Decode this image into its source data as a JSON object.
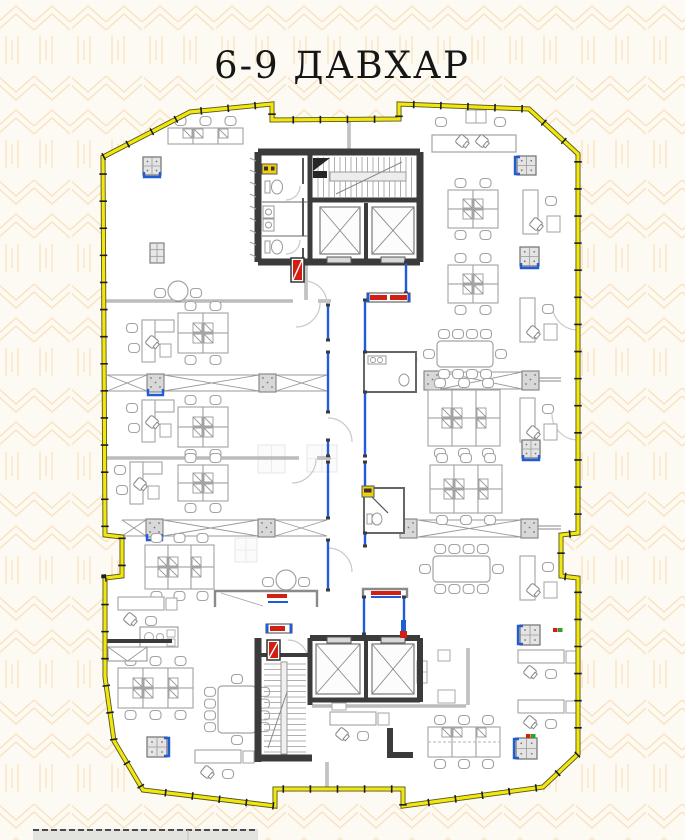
{
  "title": "6-9 ДАВХАР",
  "colors": {
    "bg": "#fdfaf3",
    "pattern": "#f8e2bb",
    "floor": "#ffffff",
    "outer_yellow": "#f2e70d",
    "outer_edge": "#55551f",
    "tick": "#1c1c1c",
    "wall": "#3b3b3b",
    "thin": "#787878",
    "fur": "#a3a3a3",
    "fur_light": "#e4e4e4",
    "glass": "#1f5cd6",
    "red": "#d21f14",
    "badge": "#f2cf0a",
    "green": "#2fa12f",
    "ghost": "#cccccc",
    "strip_fill": "#e3e3e0",
    "strip_border": "#4a4a4a"
  },
  "outline": [
    [
      103,
      157
    ],
    [
      190,
      112
    ],
    [
      272,
      104
    ],
    [
      272,
      120
    ],
    [
      399,
      119
    ],
    [
      399,
      104
    ],
    [
      529,
      109
    ],
    [
      578,
      154
    ],
    [
      578,
      533
    ],
    [
      561,
      535
    ],
    [
      561,
      576
    ],
    [
      578,
      578
    ],
    [
      578,
      754
    ],
    [
      543,
      787
    ],
    [
      403,
      806
    ],
    [
      403,
      789
    ],
    [
      275,
      789
    ],
    [
      275,
      806
    ],
    [
      143,
      790
    ],
    [
      114,
      741
    ],
    [
      105,
      677
    ],
    [
      105,
      578
    ],
    [
      122,
      576
    ],
    [
      122,
      537
    ],
    [
      105,
      535
    ]
  ],
  "thin_walls": [
    [
      105,
      301,
      293,
      301
    ],
    [
      318,
      301,
      331,
      301
    ],
    [
      105,
      458,
      299,
      458
    ],
    [
      317,
      458,
      331,
      458
    ],
    [
      312,
      706,
      466,
      706
    ],
    [
      468,
      648,
      468,
      705
    ],
    [
      327,
      762,
      327,
      789
    ],
    [
      349,
      122,
      349,
      152
    ],
    [
      306,
      262,
      306,
      300
    ]
  ],
  "dark_walls": [
    [
      258,
      152,
      420,
      152,
      7
    ],
    [
      258,
      152,
      258,
      262,
      7
    ],
    [
      420,
      152,
      420,
      262,
      7
    ],
    [
      258,
      262,
      420,
      262,
      7
    ],
    [
      310,
      155,
      310,
      259,
      5
    ],
    [
      310,
      200,
      420,
      200,
      5
    ],
    [
      366,
      203,
      366,
      259,
      4
    ],
    [
      258,
      638,
      258,
      762,
      7
    ],
    [
      310,
      638,
      310,
      705,
      5
    ],
    [
      310,
      638,
      420,
      638,
      6
    ],
    [
      420,
      638,
      420,
      702,
      6
    ],
    [
      366,
      640,
      366,
      700,
      4
    ],
    [
      312,
      700,
      420,
      700,
      5
    ],
    [
      258,
      655,
      310,
      655,
      4
    ],
    [
      258,
      758,
      312,
      758,
      7
    ],
    [
      390,
      728,
      390,
      758,
      6
    ],
    [
      388,
      755,
      413,
      755,
      6
    ],
    [
      105,
      641,
      172,
      641,
      4
    ]
  ],
  "glass": [
    [
      328,
      305,
      328,
      340
    ],
    [
      328,
      352,
      328,
      412
    ],
    [
      328,
      440,
      328,
      456
    ],
    [
      328,
      462,
      328,
      518
    ],
    [
      328,
      540,
      328,
      590
    ],
    [
      365,
      300,
      365,
      352
    ],
    [
      365,
      392,
      365,
      456
    ],
    [
      365,
      462,
      365,
      488
    ],
    [
      365,
      533,
      365,
      546
    ],
    [
      364,
      597,
      364,
      634
    ],
    [
      404,
      597,
      404,
      630
    ],
    [
      406,
      262,
      406,
      293
    ],
    [
      578,
      328,
      578,
      345
    ],
    [
      578,
      412,
      578,
      438
    ]
  ],
  "arcs": [
    "M320,303 A24 24 0 0 1 296,327",
    "M316,459 A24 24 0 0 1 292,483",
    "M328,418 A24 24 0 0 1 352,442",
    "M328,548 A24 24 0 0 1 352,572",
    "M304,281 A23 23 0 0 1 327,304",
    "M417,358 A18 18 0 0 1 399,376",
    "M398,532 A18 18 0 0 0 380,514",
    "M288,640 A20 20 0 0 1 308,660",
    "M300,186 A14 14 0 0 1 286,200",
    "M300,240 A14 14 0 0 1 286,254",
    "M578,330 A26 26 0 0 1 552,304",
    "M578,440 A26 26 0 0 1 552,414"
  ],
  "strips": [
    {
      "y": 375,
      "h": 16,
      "posts": [
        147,
        259
      ],
      "spans": [
        [
          107,
          147
        ],
        [
          164,
          259
        ],
        [
          276,
          327
        ]
      ],
      "tail": null,
      "blue": [
        147
      ]
    },
    {
      "y": 520,
      "h": 16,
      "posts": [
        146,
        258
      ],
      "spans": [
        [
          122,
          146
        ],
        [
          163,
          258
        ],
        [
          275,
          327
        ]
      ],
      "tail": null,
      "blue": [
        146
      ]
    },
    {
      "y": 372,
      "h": 17,
      "posts": [
        424,
        522
      ],
      "spans": [
        [
          441,
          522
        ]
      ],
      "tail": [
        539,
        561
      ],
      "blue": []
    },
    {
      "y": 520,
      "h": 17,
      "posts": [
        400,
        521
      ],
      "spans": [
        [
          418,
          521
        ]
      ],
      "tail": [
        538,
        561
      ],
      "blue": []
    }
  ],
  "pods": [
    {
      "x": 178,
      "y": 313,
      "cols": 2,
      "rows": 2,
      "cw": 25,
      "ch": 20
    },
    {
      "x": 178,
      "y": 407,
      "cols": 2,
      "rows": 2,
      "cw": 25,
      "ch": 20
    },
    {
      "x": 178,
      "y": 465,
      "cols": 2,
      "rows": 2,
      "cw": 25,
      "ch": 18
    },
    {
      "x": 145,
      "y": 545,
      "cols": 3,
      "rows": 2,
      "cw": 23,
      "ch": 22
    },
    {
      "x": 448,
      "y": 190,
      "cols": 2,
      "rows": 2,
      "cw": 25,
      "ch": 19
    },
    {
      "x": 448,
      "y": 265,
      "cols": 2,
      "rows": 2,
      "cw": 25,
      "ch": 19
    },
    {
      "x": 428,
      "y": 390,
      "cols": 3,
      "rows": 2,
      "cw": 24,
      "ch": 28
    },
    {
      "x": 430,
      "y": 465,
      "cols": 3,
      "rows": 2,
      "cw": 24,
      "ch": 24
    },
    {
      "x": 118,
      "y": 668,
      "cols": 3,
      "rows": 2,
      "cw": 25,
      "ch": 20
    },
    {
      "x": 168,
      "y": 128,
      "cols": 3,
      "rows": 1,
      "cw": 25,
      "ch": 16,
      "chairs": "top"
    },
    {
      "x": 428,
      "y": 727,
      "cols": 3,
      "rows": 1,
      "cw": 24,
      "ch": 30,
      "dash": true
    }
  ],
  "confs": [
    {
      "x": 437,
      "y": 341,
      "w": 56,
      "h": 26,
      "dir": "h",
      "n": 4
    },
    {
      "x": 433,
      "y": 556,
      "w": 57,
      "h": 26,
      "dir": "h",
      "n": 4
    },
    {
      "x": 218,
      "y": 686,
      "w": 38,
      "h": 47,
      "dir": "v",
      "n": 4
    }
  ],
  "rounds": [
    {
      "cx": 178,
      "cy": 291,
      "r": 10
    },
    {
      "cx": 286,
      "cy": 580,
      "r": 10
    }
  ],
  "ldesks": [
    {
      "x": 130,
      "y": 320,
      "t": "L"
    },
    {
      "x": 130,
      "y": 400,
      "t": "L"
    },
    {
      "x": 118,
      "y": 462,
      "t": "L"
    },
    {
      "x": 523,
      "y": 190,
      "t": "R"
    },
    {
      "x": 520,
      "y": 298,
      "t": "R"
    },
    {
      "x": 520,
      "y": 398,
      "t": "R"
    },
    {
      "x": 520,
      "y": 556,
      "t": "R"
    },
    {
      "x": 518,
      "y": 650,
      "t": "H"
    },
    {
      "x": 518,
      "y": 700,
      "t": "H"
    },
    {
      "x": 118,
      "y": 597,
      "t": "H"
    },
    {
      "x": 195,
      "y": 750,
      "t": "H"
    },
    {
      "x": 330,
      "y": 712,
      "t": "H"
    }
  ],
  "cabs": [
    {
      "x": 143,
      "y": 157,
      "s": 18,
      "blue": "B"
    },
    {
      "x": 517,
      "y": 156,
      "s": 19,
      "blue": "L"
    },
    {
      "x": 520,
      "y": 247,
      "s": 19,
      "blue": "B"
    },
    {
      "x": 522,
      "y": 440,
      "s": 18,
      "blue": "B"
    },
    {
      "x": 520,
      "y": 625,
      "s": 20,
      "blue": "L"
    },
    {
      "x": 516,
      "y": 738,
      "s": 21,
      "blue": "L"
    },
    {
      "x": 147,
      "y": 737,
      "s": 20,
      "blue": "R"
    }
  ],
  "copier": {
    "x": 150,
    "y": 243,
    "w": 14,
    "h": 20
  },
  "ghosts": [
    [
      258,
      445,
      27,
      28
    ],
    [
      307,
      445,
      30,
      27
    ],
    [
      235,
      538,
      22,
      24
    ]
  ],
  "benches": [
    {
      "x": 367,
      "y": 293,
      "w": 43,
      "h": 9
    },
    {
      "x": 266,
      "y": 624,
      "w": 26,
      "h": 9
    }
  ],
  "fire": [
    {
      "x": 291,
      "y": 258,
      "w": 13,
      "h": 24
    },
    {
      "x": 267,
      "y": 640,
      "w": 13,
      "h": 20
    }
  ],
  "fire_small": {
    "x": 401,
    "y": 620,
    "w": 5,
    "h": 18
  },
  "badges": [
    [
      262,
      164,
      15,
      10
    ],
    [
      362,
      486,
      12,
      11
    ]
  ],
  "marks": [
    {
      "x": 553,
      "y": 628,
      "c": "red"
    },
    {
      "x": 558,
      "y": 628,
      "c": "green"
    },
    {
      "x": 526,
      "y": 734,
      "c": "red"
    },
    {
      "x": 531,
      "y": 734,
      "c": "green"
    }
  ],
  "wc_rooms": [
    {
      "x": 364,
      "y": 352,
      "w": 52,
      "h": 40,
      "kind": 1
    },
    {
      "x": 364,
      "y": 488,
      "w": 40,
      "h": 45,
      "kind": 2
    }
  ],
  "counters": [
    {
      "x": 215,
      "y": 591,
      "w": 102,
      "h": 16,
      "red": [
        267,
        594,
        20,
        4
      ],
      "blue": [
        268,
        601,
        20,
        2
      ],
      "diag": true
    },
    {
      "x": 363,
      "y": 589,
      "w": 44,
      "h": 9,
      "red": [
        371,
        591,
        30,
        4
      ],
      "blue": [
        371,
        596,
        30,
        2
      ],
      "diag": false
    }
  ],
  "lounge": [
    [
      417,
      661,
      10,
      22
    ],
    [
      438,
      690,
      17,
      13
    ],
    [
      438,
      650,
      12,
      11
    ],
    [
      332,
      703,
      14,
      7
    ]
  ],
  "kitchen": {
    "x": 140,
    "y": 627,
    "w": 38,
    "h": 20
  },
  "envelope": {
    "x": 108,
    "y": 647,
    "w": 39,
    "h": 14
  },
  "reception_top": {
    "x": 432,
    "y": 135,
    "w": 84,
    "h": 17
  },
  "cores": {
    "top": {
      "stairs": [
        313,
        155,
        105,
        44
      ],
      "elev": [
        [
          316,
          203,
          48,
          55
        ],
        [
          368,
          203,
          50,
          55
        ]
      ],
      "sills": [
        [
          327,
          257,
          24,
          6
        ],
        [
          381,
          257,
          24,
          6
        ]
      ]
    },
    "bottom": {
      "stairs": [
        262,
        660,
        46,
        96
      ],
      "elev": [
        [
          312,
          640,
          52,
          58
        ],
        [
          368,
          640,
          50,
          58
        ]
      ],
      "sills": [
        [
          327,
          637,
          24,
          6
        ],
        [
          381,
          637,
          24,
          6
        ]
      ]
    }
  },
  "strip_table": {
    "x": 33,
    "y": 829,
    "w": 225,
    "h": 11,
    "div": 188
  }
}
